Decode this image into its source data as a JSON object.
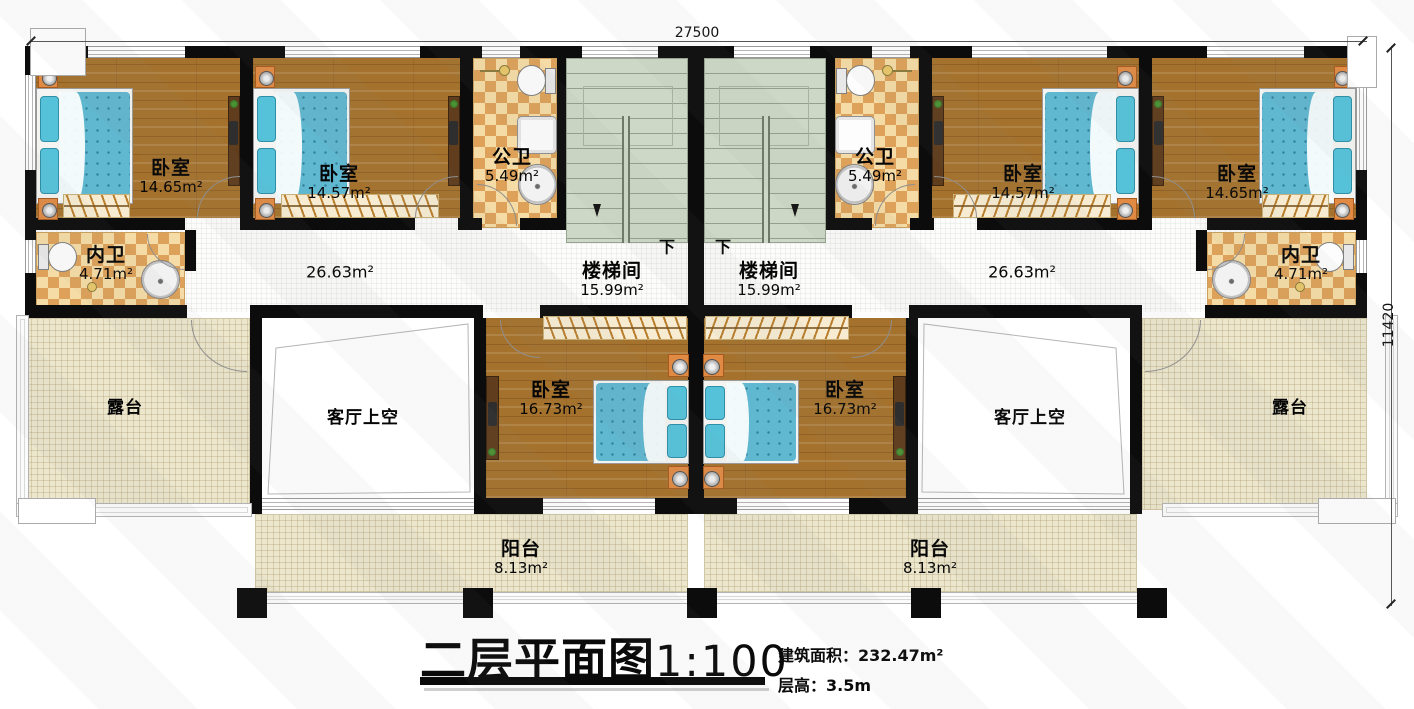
{
  "dimensions": {
    "top": "27500",
    "right": "11420"
  },
  "title": {
    "main": "二层平面图",
    "scale": "1:100",
    "area_label": "建筑面积：",
    "area_value": "232.47m²",
    "floor_height_label": "层高：",
    "floor_height_value": "3.5m"
  },
  "rooms": {
    "bedroom_a": {
      "name": "卧室",
      "area": "14.65m²"
    },
    "bedroom_b": {
      "name": "卧室",
      "area": "14.57m²"
    },
    "bedroom_c": {
      "name": "卧室",
      "area": "16.73m²"
    },
    "public_bath": {
      "name": "公卫",
      "area": "5.49m²"
    },
    "private_bath": {
      "name": "内卫",
      "area": "4.71m²"
    },
    "stairwell": {
      "name": "楼梯间",
      "area": "15.99m²"
    },
    "corridor": {
      "area": "26.63m²"
    },
    "balcony": {
      "name": "阳台",
      "area": "8.13m²"
    },
    "terrace": {
      "name": "露台"
    },
    "living_void": {
      "name": "客厅上空"
    },
    "stairs_down": "下"
  }
}
